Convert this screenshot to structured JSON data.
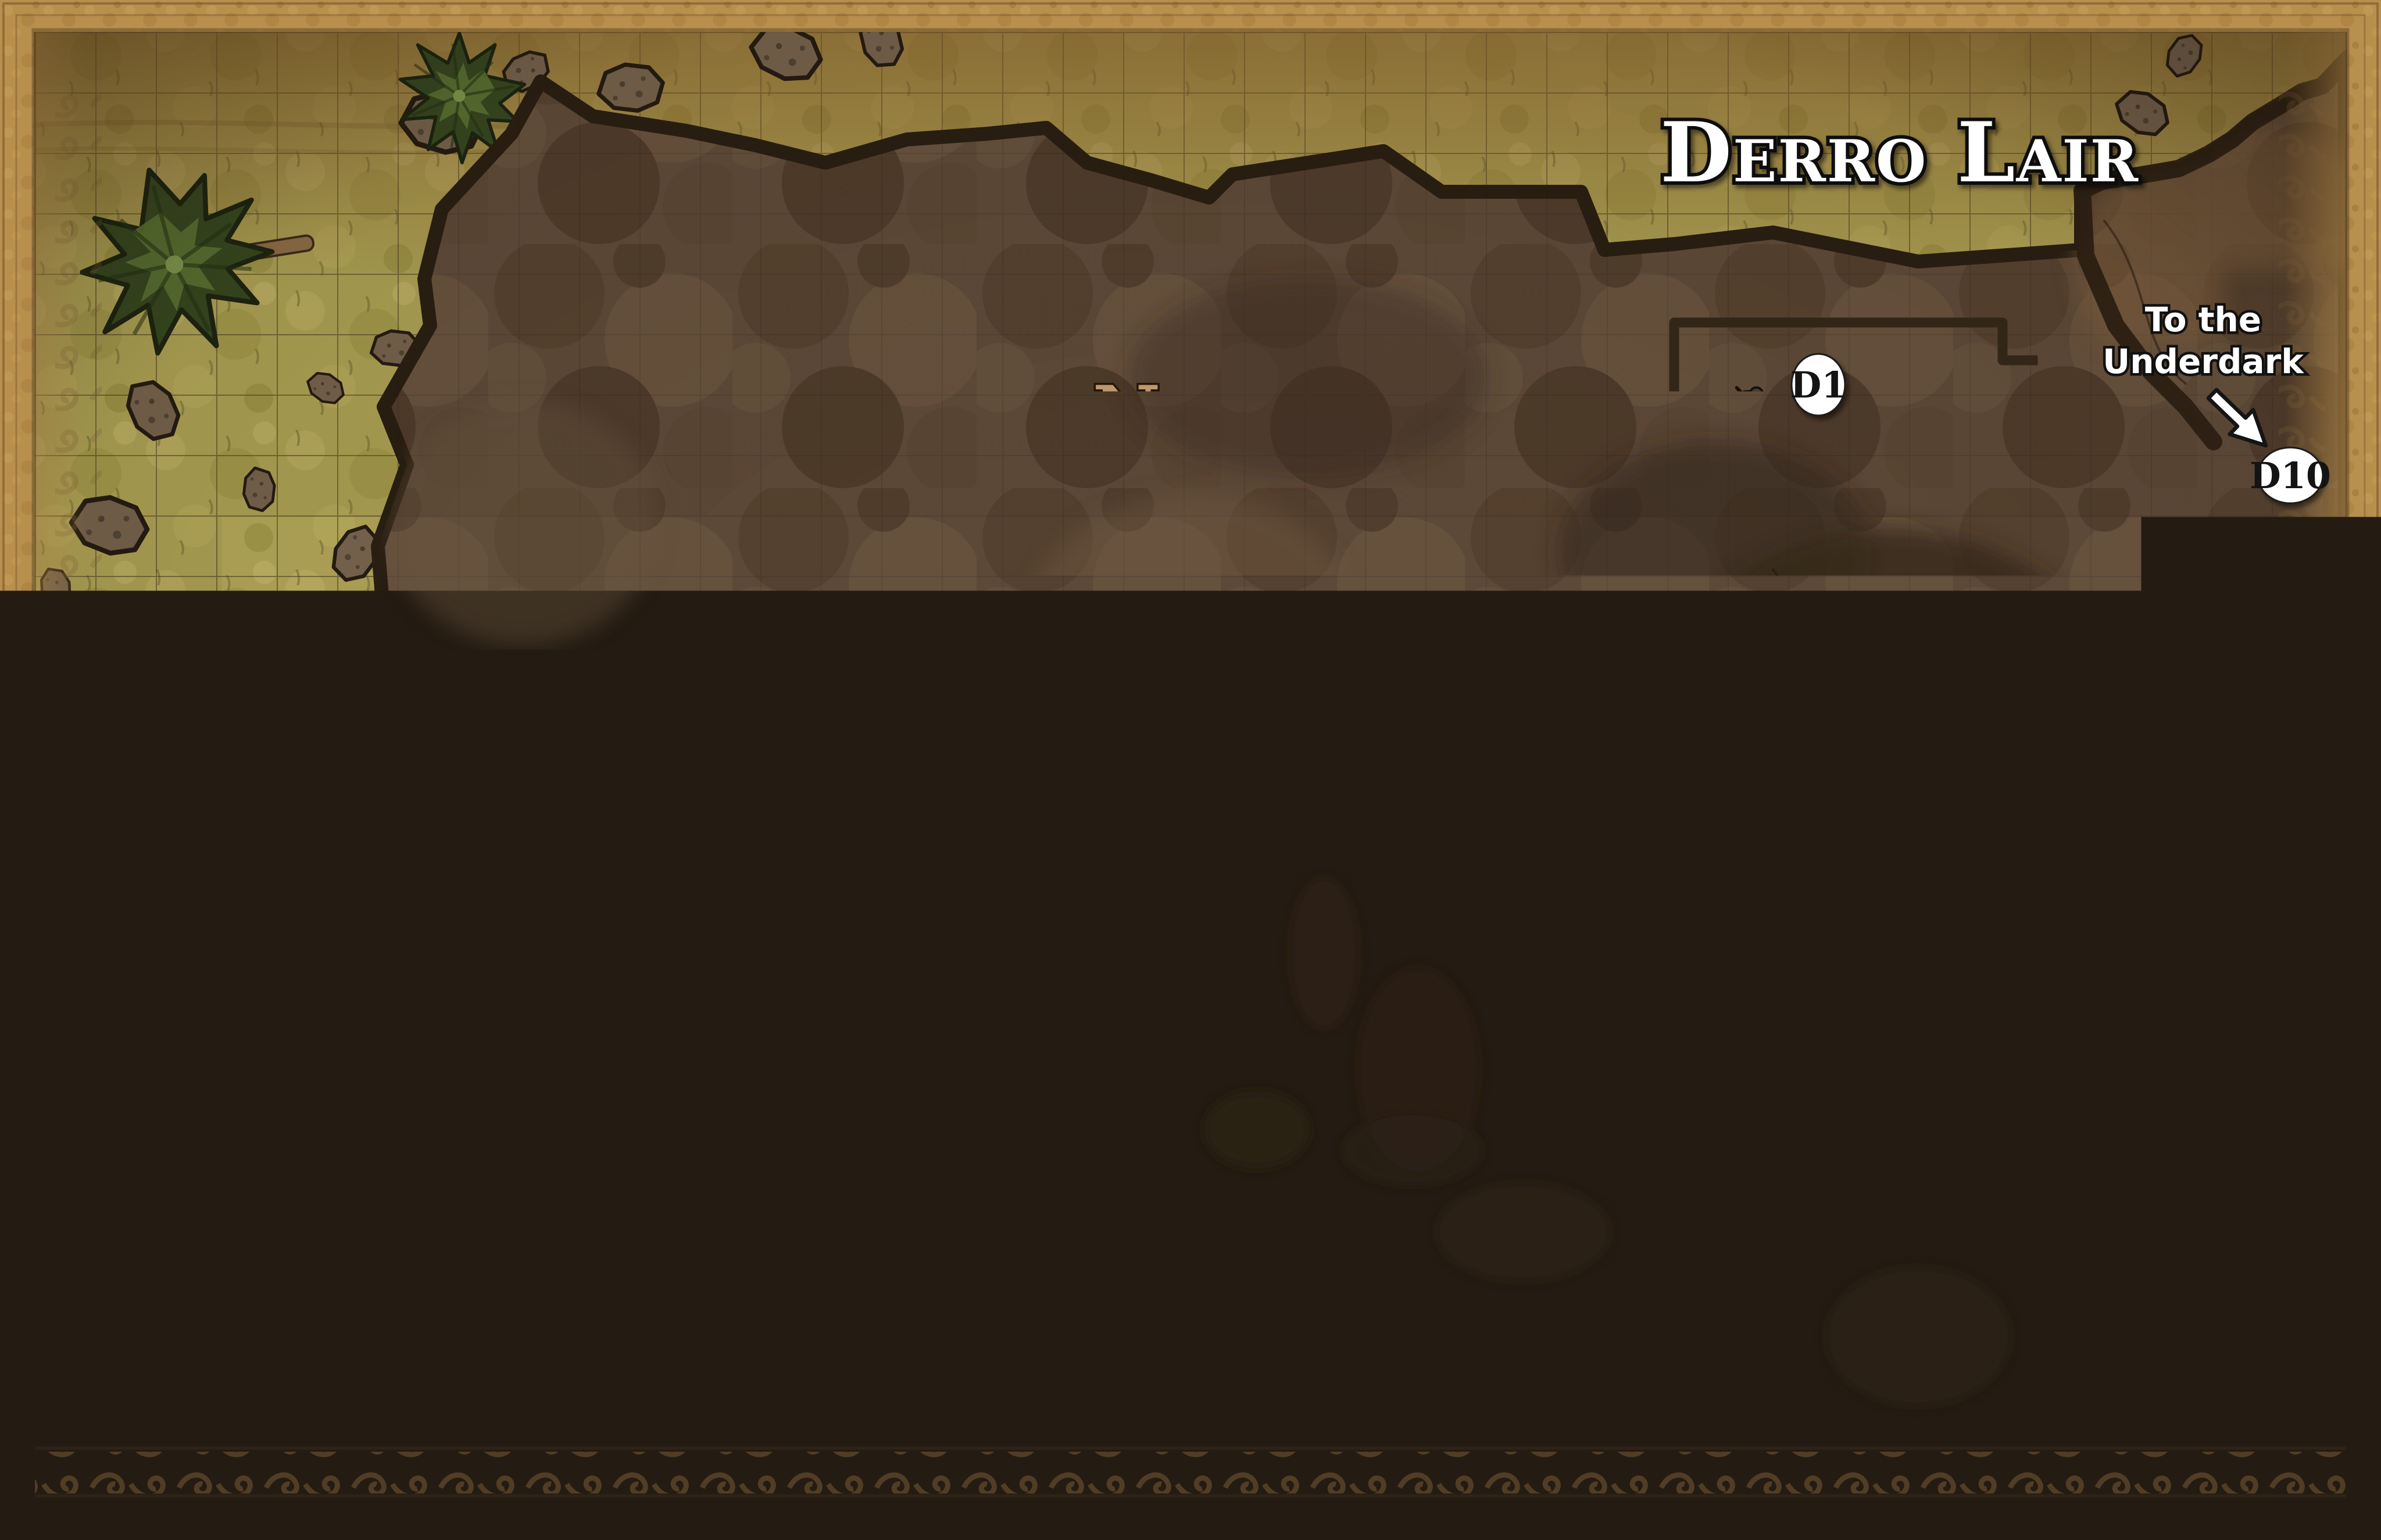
{
  "map": {
    "title": "Derro Lair",
    "compass": {
      "north_label": "N"
    },
    "rooms": [
      {
        "id": "room-d1",
        "label": "D1"
      },
      {
        "id": "room-d2",
        "label": "D2"
      },
      {
        "id": "room-d3",
        "label": "D3"
      },
      {
        "id": "room-d4",
        "label": "D4"
      },
      {
        "id": "room-d5",
        "label": "D5"
      },
      {
        "id": "room-d6",
        "label": "D6"
      },
      {
        "id": "room-d7",
        "label": "D7"
      },
      {
        "id": "room-d8",
        "label": "D8"
      },
      {
        "id": "room-d9",
        "label": "D9"
      },
      {
        "id": "room-d10",
        "label": "D10"
      }
    ],
    "annotations": {
      "underdark": {
        "line1": "To the",
        "line2": "Underdark"
      },
      "underwater_tunnel": {
        "line1": "Underwater",
        "line2": "Tunnel"
      }
    },
    "legend": {
      "scale_label": "= 10 Feet",
      "rubble_label": "Loose Rubble"
    },
    "icons": [
      "compass-rose-icon",
      "arrow-icon",
      "door-icon",
      "crate-icon",
      "barrel-icon",
      "chest-icon",
      "loose-rubble-icon",
      "corpse-icon",
      "bone-pile-icon",
      "tree-icon",
      "rock-icon",
      "rune-circle-icon",
      "cushion-pile-icon",
      "grid-scale-swatch"
    ],
    "colors": {
      "border_gold": "#b88f4d",
      "grass": "#a89d52",
      "cave_floor": "#5d4938",
      "wall": "#33271a",
      "tile_floor": "#d8ccb4",
      "green_tiles": "#c3d2a2",
      "water": "#a9bdc8",
      "label_bg": "#ffffff",
      "label_text": "#141414",
      "title_fill": "#ffffff",
      "north_letter": "#c49d6d"
    }
  }
}
